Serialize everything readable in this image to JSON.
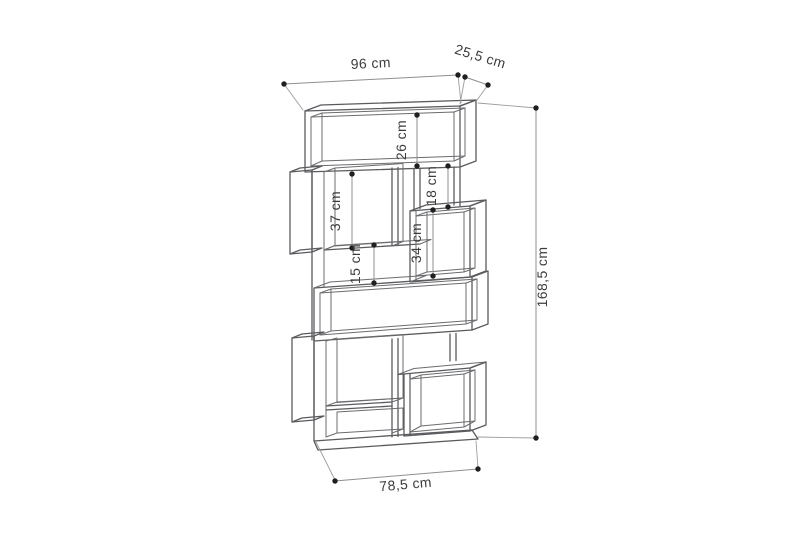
{
  "diagram": {
    "subject": "zigzag modular bookshelf dimension drawing",
    "dimensions": {
      "width_top": "96 cm",
      "depth": "25,5 cm",
      "top_compartment_height": "26 cm",
      "upper_left_compartment_height": "37 cm",
      "upper_right_small_compartment_height": "18 cm",
      "middle_right_compartment_height": "34 cm",
      "left_gap_height": "15 cm",
      "total_height": "168,5 cm",
      "width_bottom": "78,5 cm"
    }
  }
}
